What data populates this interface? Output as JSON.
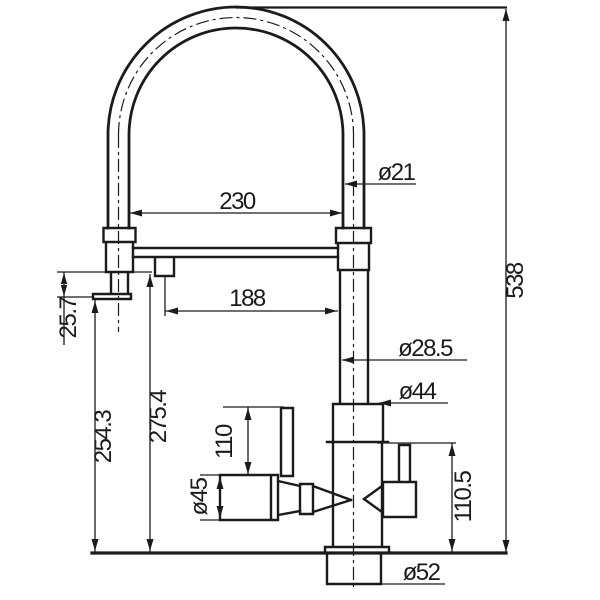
{
  "drawing": {
    "background": "#ffffff",
    "line_color": "#1b1b1b",
    "labels": {
      "hose_diameter": "ø21",
      "arch_width": "230",
      "overall_height": "538",
      "spout_reach": "188",
      "head_offset": "25.7",
      "outlet_height": "254.3",
      "spout_height": "275.4",
      "riser_diameter": "ø28.5",
      "body_diameter": "ø44",
      "handle_length": "110",
      "handle_diameter": "ø45",
      "handle_height": "110.5",
      "base_diameter": "ø52"
    }
  }
}
